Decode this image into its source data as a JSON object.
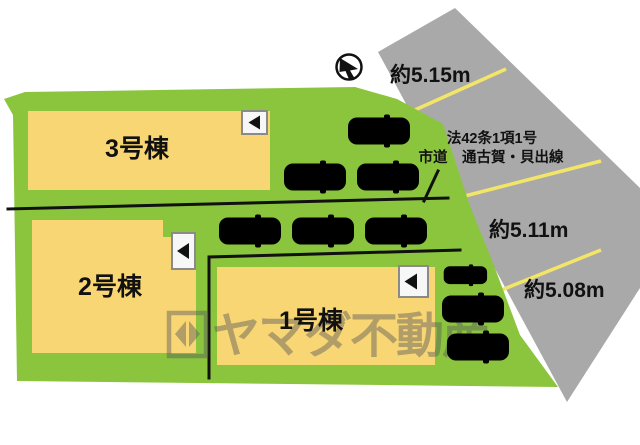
{
  "plan": {
    "type": "residential-site-plan",
    "buildings": [
      {
        "id": "unit-3",
        "label": "3号棟"
      },
      {
        "id": "unit-2",
        "label": "2号棟"
      },
      {
        "id": "unit-1",
        "label": "1号棟"
      }
    ],
    "road": {
      "designation": "法42条1項1号",
      "name": "市道　通古賀・貝出線",
      "frontage_widths": [
        "約5.15m",
        "約5.11m",
        "約5.08m"
      ]
    },
    "cars": {
      "blue_count": 5,
      "red_count": 4
    },
    "icons": {
      "unit_direction": "left-triangle",
      "compass": "north-arrow"
    },
    "watermark": {
      "text": "ヤマダ不動産"
    }
  },
  "colors": {
    "land": "#8bc53e",
    "building": "#f8d674",
    "road": "#a9a9a9",
    "road_line": "#f3e567",
    "car_red": "#df1418",
    "car_blue": "#5fa9dc"
  }
}
